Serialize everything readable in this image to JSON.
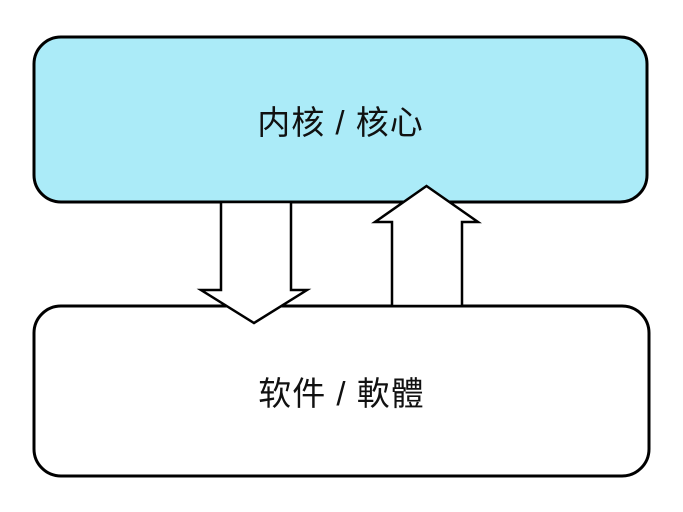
{
  "diagram": {
    "background": "#FFFFFF",
    "text_color": "#111111",
    "top_box": {
      "label": "内核 / 核心",
      "fill": "#ABEBF8",
      "border_color": "#000000"
    },
    "bottom_box": {
      "label": "软件 / 軟體",
      "fill": "#FFFFFF",
      "border_color": "#000000"
    },
    "down_arrow": {
      "direction": "down",
      "fill": "#FFFFFF",
      "stroke": "#000000"
    },
    "up_arrow": {
      "direction": "up",
      "fill": "#FFFFFF",
      "stroke": "#000000"
    }
  }
}
